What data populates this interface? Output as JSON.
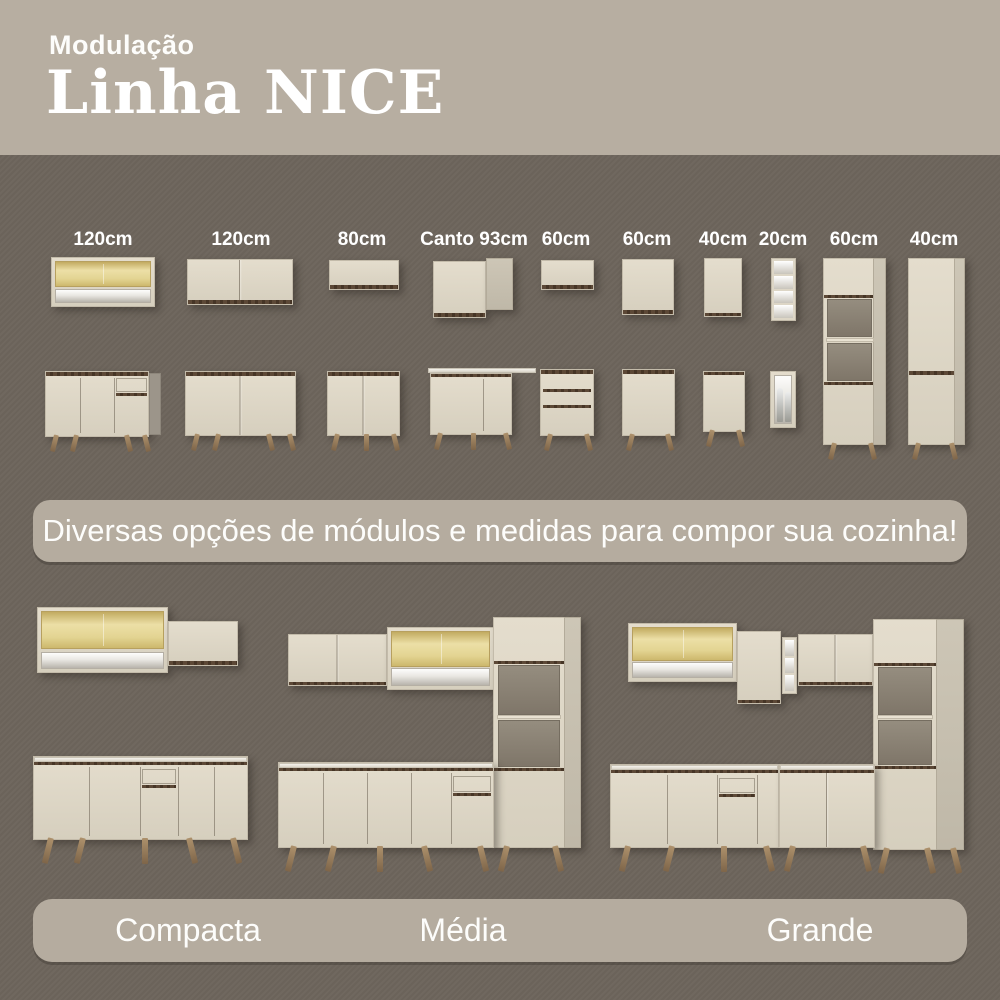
{
  "header": {
    "subtitle": "Modulação",
    "title": "Linha NICE"
  },
  "modules": {
    "labels": [
      "120cm",
      "120cm",
      "80cm",
      "Canto 93cm",
      "60cm",
      "60cm",
      "40cm",
      "20cm",
      "60cm",
      "40cm"
    ]
  },
  "banner": {
    "text": "Diversas opções de módulos e medidas para compor sua cozinha!"
  },
  "kitchens": {
    "sizes": [
      {
        "label": "Compacta"
      },
      {
        "label": "Média"
      },
      {
        "label": "Grande"
      }
    ]
  },
  "colors": {
    "page_bg": "#6e665d",
    "header_bg": "#b7aea1",
    "pill_bg": "#b5ac9f",
    "cabinet_cream": "#ddd6c6",
    "wood_strip": "#54402f",
    "glass_yellow": "#e6d492",
    "leg_wood": "#a0835f",
    "text": "#ffffff"
  }
}
